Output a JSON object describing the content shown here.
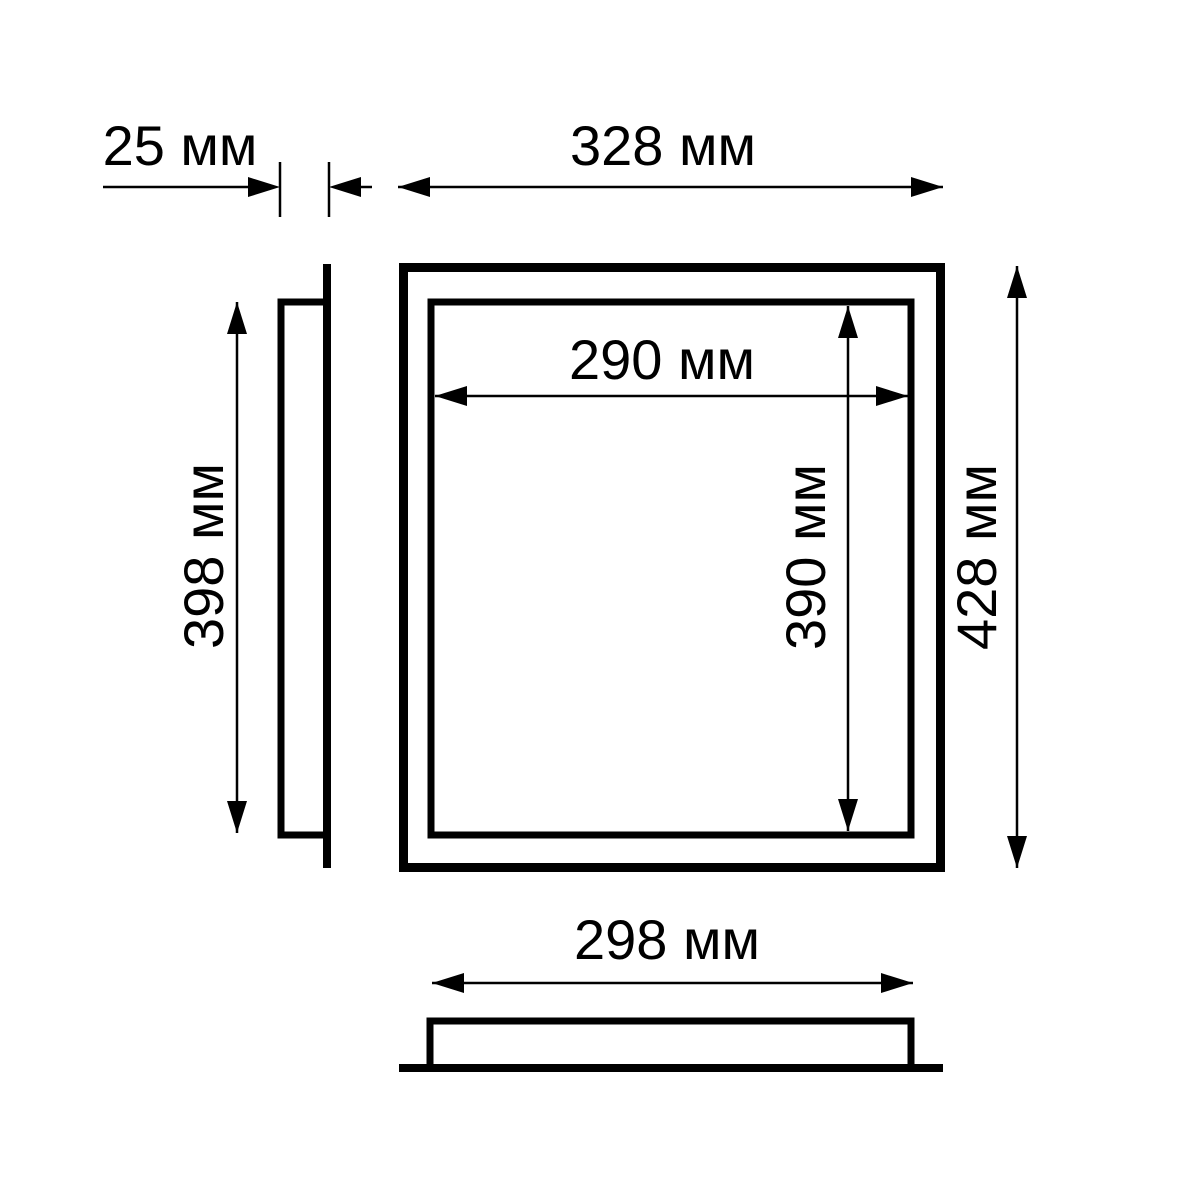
{
  "drawing": {
    "background_color": "#ffffff",
    "line_color": "#000000",
    "unit": "мм",
    "dimensions": {
      "depth": {
        "label": "25 мм",
        "value_mm": 25
      },
      "outer_width": {
        "label": "328 мм",
        "value_mm": 328
      },
      "inner_width": {
        "label": "290 мм",
        "value_mm": 290
      },
      "side_height": {
        "label": "398 мм",
        "value_mm": 398
      },
      "inner_height": {
        "label": "390 мм",
        "value_mm": 390
      },
      "outer_height": {
        "label": "428 мм",
        "value_mm": 428
      },
      "bottom_width": {
        "label": "298 мм",
        "value_mm": 298
      }
    }
  }
}
